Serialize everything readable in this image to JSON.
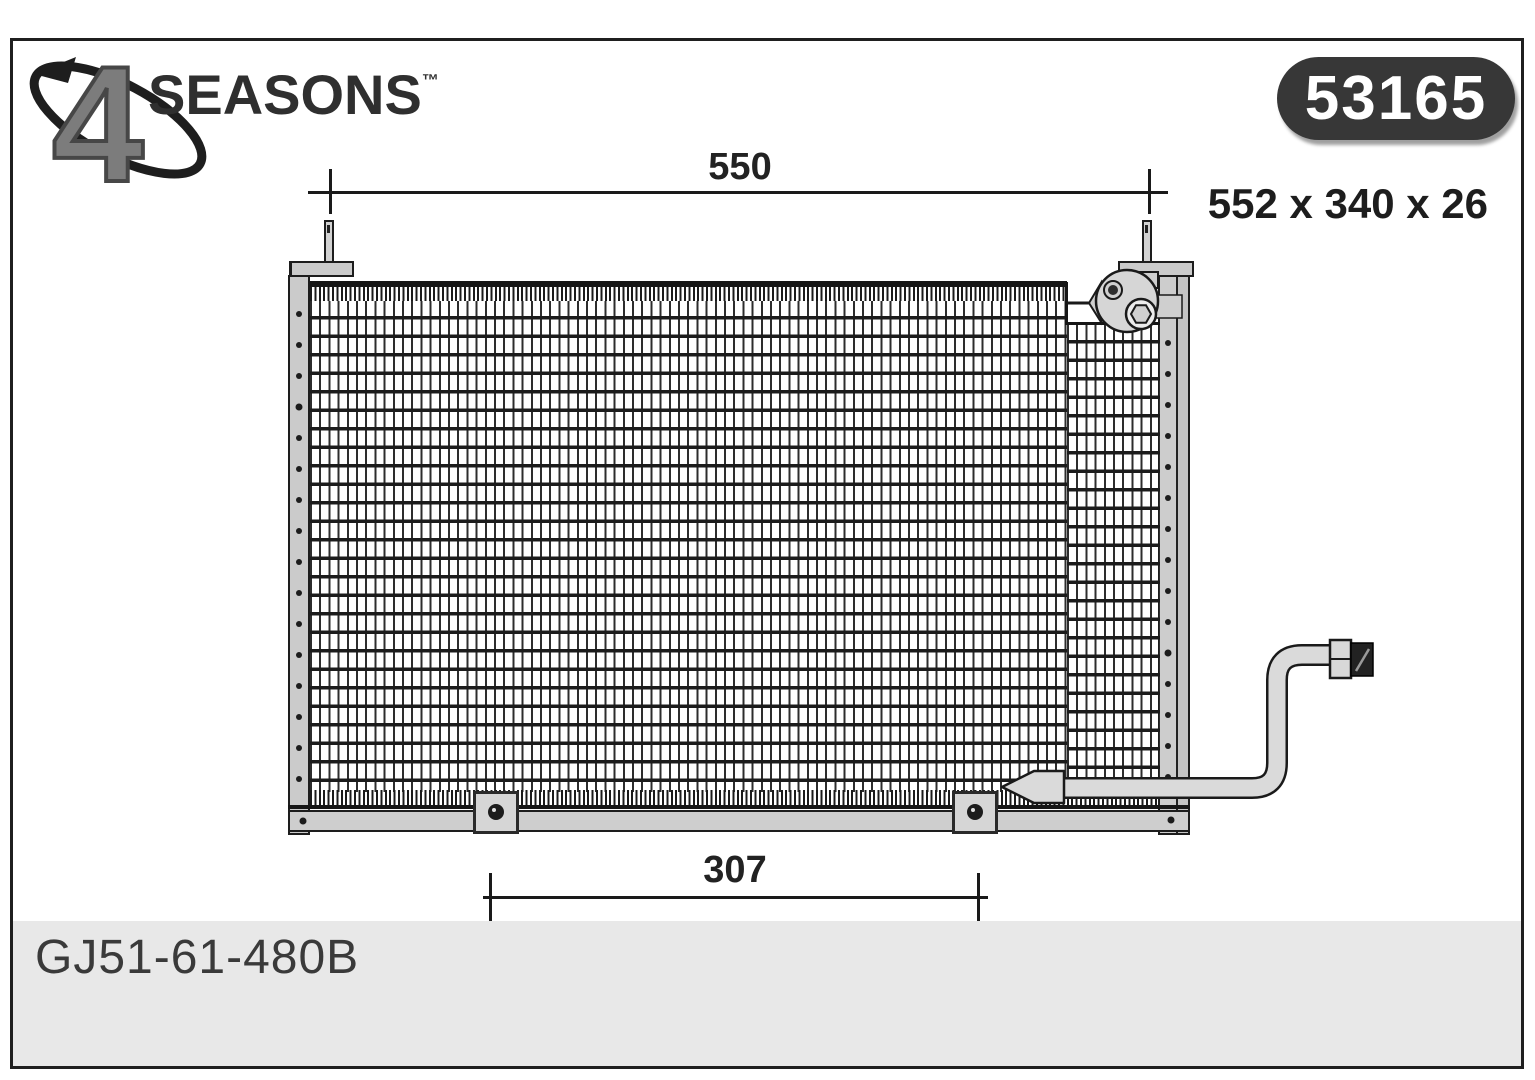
{
  "brand": {
    "number": "4",
    "name": "SEASONS",
    "trademark": "™"
  },
  "badge": {
    "part_number": "53165",
    "background": "#373737",
    "text_color": "#ffffff"
  },
  "size_label": "552 x 340 x 26",
  "dim_top": {
    "value": "550"
  },
  "dim_bottom": {
    "value": "307"
  },
  "footer": {
    "oem_number": "GJ51-61-480B",
    "background": "#e8e8e8"
  },
  "drawing": {
    "line_color": "#1a1a1a",
    "metal_fill": "#d2d2d2",
    "part": "a/c condenser"
  }
}
